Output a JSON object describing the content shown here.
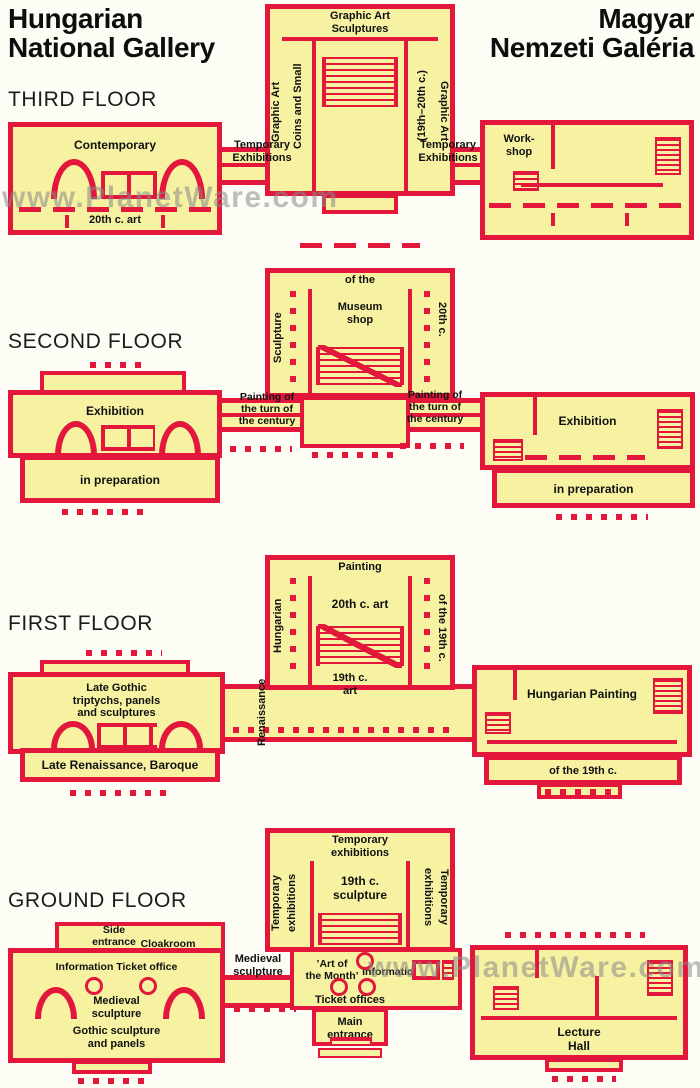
{
  "header": {
    "left1": "Hungarian",
    "left2": "National Gallery",
    "right1": "Magyar",
    "right2": "Nemzeti Galéria"
  },
  "watermark": "www.PlanetWare.com",
  "colors": {
    "wall_red": "#e2173b",
    "room_yellow": "#f6f2a2",
    "text_black": "#111111",
    "watermark_gray": "#8a8a8a"
  },
  "floors": {
    "third": {
      "title": "THIRD FLOOR",
      "tower_top1": "Graphic Art",
      "tower_top2": "Sculptures",
      "tower_left_outer": "Graphic Art",
      "tower_left_inner": "Coins and Small",
      "tower_right_inner": "(19th–20th c.)",
      "tower_right_outer": "Graphic Art",
      "left_main": "Contemporary",
      "left_lower": "20th c. art",
      "corr_left1": "Temporary",
      "corr_left2": "Exhibitions",
      "corr_right1": "Temporary",
      "corr_right2": "Exhibitions",
      "right_main1": "Work-",
      "right_main2": "shop"
    },
    "second": {
      "title": "SECOND FLOOR",
      "tower_top": "of the",
      "tower_left": "Sculpture",
      "tower_right": "20th c.",
      "tower_center1": "Museum",
      "tower_center2": "shop",
      "left_main": "Exhibition",
      "left_lower": "in preparation",
      "corr_left1": "Painting of",
      "corr_left2": "the turn of",
      "corr_left3": "the century",
      "corr_right1": "Painting of",
      "corr_right2": "the turn of",
      "corr_right3": "the century",
      "right_main": "Exhibition",
      "right_lower": "in preparation"
    },
    "first": {
      "title": "FIRST FLOOR",
      "tower_top": "Painting",
      "tower_left": "Hungarian",
      "tower_right": "of the 19th c.",
      "tower_center": "20th c. art",
      "below_tower1": "19th c.",
      "below_tower2": "art",
      "corr_vertical": "Renaissance",
      "left_main1": "Late Gothic",
      "left_main2": "triptychs, panels",
      "left_main3": "and sculptures",
      "left_lower": "Late Renaissance, Baroque",
      "right_main": "Hungarian Painting",
      "right_lower": "of the 19th c."
    },
    "ground": {
      "title": "GROUND FLOOR",
      "tower_top1": "Temporary",
      "tower_top2": "exhibitions",
      "tower_left_outer": "Temporary",
      "tower_left_inner": "exhibitions",
      "tower_right_inner": "exhibitions",
      "tower_right_outer": "Temporary",
      "tower_center1": "19th c.",
      "tower_center2": "sculpture",
      "side_entrance1": "Side",
      "side_entrance2": "entrance",
      "cloakroom": "Cloakroom",
      "info_ticket": "Information Ticket office",
      "medieval1": "Medieval",
      "medieval2": "sculpture",
      "gothic1": "Gothic sculpture",
      "gothic2": "and panels",
      "corr_medieval1": "Medieval",
      "corr_medieval2": "sculpture",
      "art_month1": "’Art of",
      "art_month2": "the Month’",
      "information": "Information",
      "ticket_offices": "Ticket offices",
      "main_entrance1": "Main",
      "main_entrance2": "entrance",
      "lecture1": "Lecture",
      "lecture2": "Hall"
    }
  }
}
